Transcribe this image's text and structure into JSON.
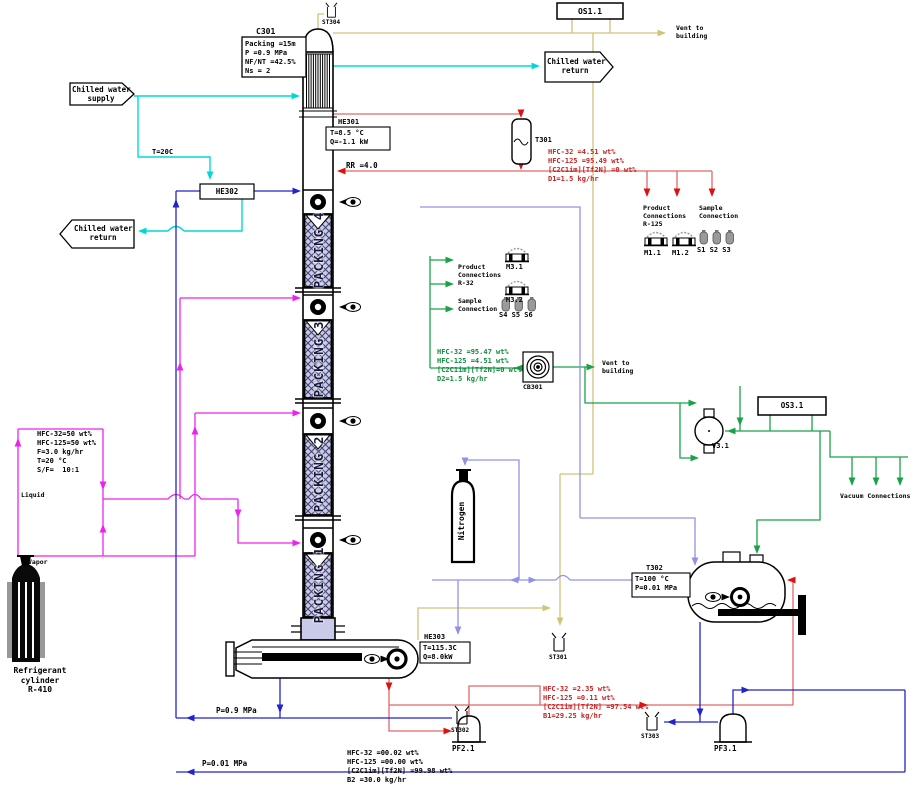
{
  "labels": {
    "c301": "C301",
    "he301": "HE301",
    "he302": "HE302",
    "he303": "HE303",
    "t301": "T301",
    "t302": "T302",
    "cb301": "CB301",
    "v31": "V3.1",
    "os11": "OS1.1",
    "os31": "OS3.1",
    "st301": "ST301",
    "st302": "ST302",
    "st303": "ST303",
    "st304": "ST304",
    "pf21": "PF2.1",
    "pf31": "PF3.1",
    "m11": "M1.1",
    "m12": "M1.2",
    "m31": "M3.1",
    "m32": "M3.2",
    "s123": "S1 S2 S3",
    "s456": "S4 S5 S6",
    "nitrogen": "Nitrogen",
    "liquid": "Liquid",
    "vapor": "Vapor",
    "rr": "RR =4.0",
    "t20c": "T=20C",
    "p_high": "P=0.9 MPa",
    "p_low": "P=0.01 MPa",
    "vacuum": "Vacuum Connections"
  },
  "column_info": {
    "l1": "Packing =15m",
    "l2": "P =0.9 MPa",
    "l3": "NF/NT =42.5%",
    "l4": "Ns = 2"
  },
  "he301_info": {
    "l1": "T=8.5 °C",
    "l2": "Q=-1.1 kW"
  },
  "he303_info": {
    "l1": "T=115.3C",
    "l2": "Q=8.0kW"
  },
  "t302_info": {
    "l1": "T=100 °C",
    "l2": "P=0.01 MPa"
  },
  "packing": {
    "p4": "PACKING 4",
    "p3": "PACKING 3",
    "p2": "PACKING 2",
    "p1": "PACKING 1"
  },
  "flow_arrows": {
    "chw_supply": {
      "l1": "Chilled water",
      "l2": "supply"
    },
    "chw_return_top": {
      "l1": "Chilled water",
      "l2": "return"
    },
    "chw_return_left": {
      "l1": "Chilled water",
      "l2": "return"
    },
    "vent_top": {
      "l1": "Vent to",
      "l2": "building"
    },
    "vent_mid": {
      "l1": "Vent to",
      "l2": "building"
    }
  },
  "connections": {
    "r125_product": {
      "l1": "Product",
      "l2": "Connections",
      "l3": "R-125"
    },
    "r125_sample": {
      "l1": "Sample",
      "l2": "Connection"
    },
    "r32_product": {
      "l1": "Product",
      "l2": "Connections",
      "l3": "R-32"
    },
    "r32_sample": {
      "l1": "Sample",
      "l2": "Connection"
    }
  },
  "cylinders": {
    "refrigerant": {
      "l1": "Refrigerant",
      "l2": "cylinder",
      "l3": "R-410"
    }
  },
  "streams": {
    "feed": {
      "l1": "HFC-32=50 wt%",
      "l2": "HFC-125=50 wt%",
      "l3": "F=3.0 kg/hr",
      "l4": "T=20 °C",
      "l5": "S/F=  10:1"
    },
    "d1": {
      "l1": "HFC-32 =4.51 wt%",
      "l2": "HFC-125 =95.49 wt%",
      "l3": "[C2C1im][Tf2N] =0 wt%",
      "l4": "D1=1.5 kg/hr"
    },
    "d2": {
      "l1": "HFC-32 =95.47 wt%",
      "l2": "HFC-125 =4.51 wt%",
      "l3": "[C2C1im][Tf2N]=0 wt%",
      "l4": "D2=1.5 kg/hr"
    },
    "b1": {
      "l1": "HFC-32 =2.35 wt%",
      "l2": "HFC-125 =0.11 wt%",
      "l3": "[C2C1im][Tf2N] =97.54 wt%",
      "l4": "B1=29.25 kg/hr"
    },
    "b2": {
      "l1": "HFC-32 =00.02 wt%",
      "l2": "HFC-125 =00.00 wt%",
      "l3": "[C2C1im][Tf2N] =99.98 wt%",
      "l4": "B2 =30.0 kg/hr"
    }
  },
  "colors": {
    "chilled_water": "#00d8d8",
    "distillate_r125": "#e06868",
    "arrow_red": "#e01010",
    "product_r32": "#18a34a",
    "feed": "#ee22ee",
    "solvent": "#2323cc",
    "nitrogen": "#9292e2",
    "vent": "#cfc478",
    "packing_fill": "#c9c9ea"
  }
}
